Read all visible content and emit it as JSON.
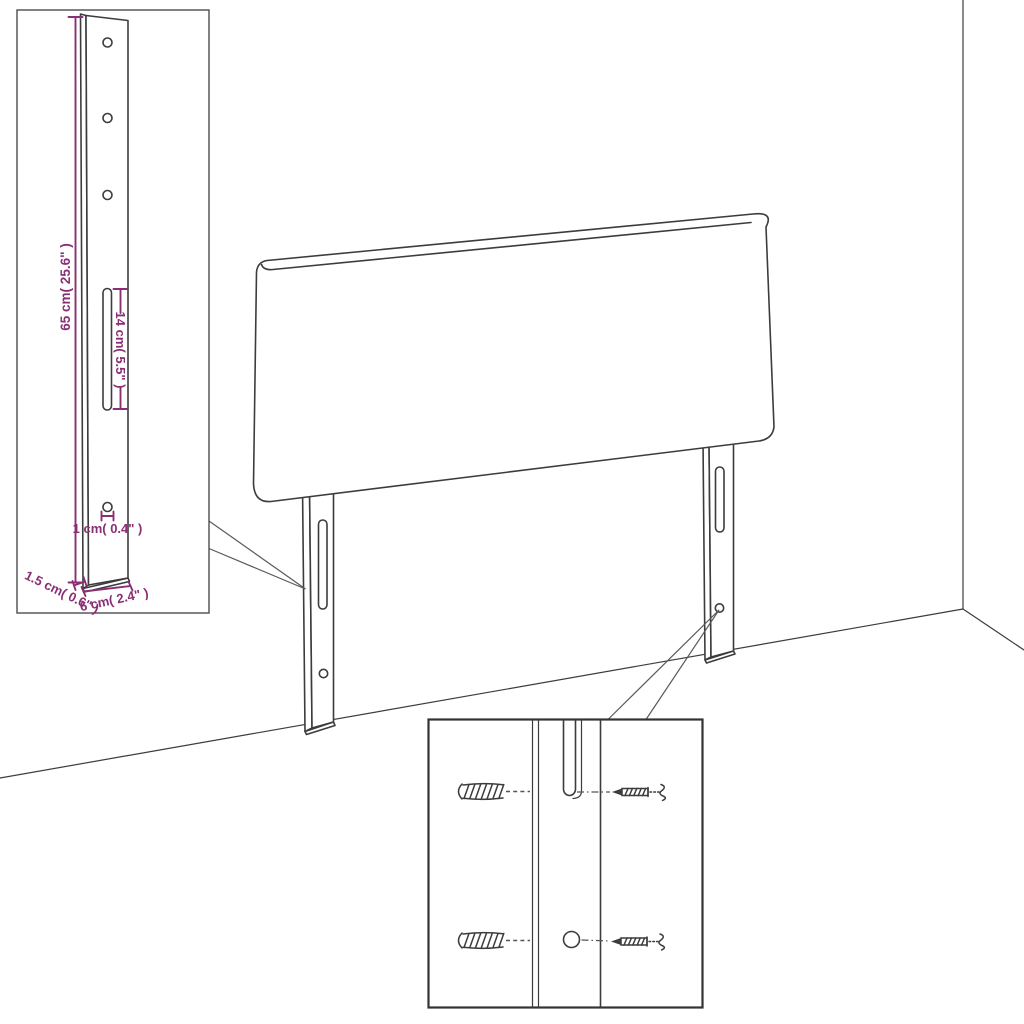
{
  "colors": {
    "background": "#ffffff",
    "line": "#3c3c3c",
    "dimension": "#8a2f74"
  },
  "insets": {
    "bracket_detail": {
      "dim_total_height": "65 cm( 25.6\" )",
      "dim_slot_length": "14 cm( 5.5\" )",
      "dim_hole": "1 cm( 0.4\" )",
      "dim_thickness": "1.5 cm( 0.6\" )",
      "dim_width": "6 cm( 2.4\" )"
    }
  }
}
